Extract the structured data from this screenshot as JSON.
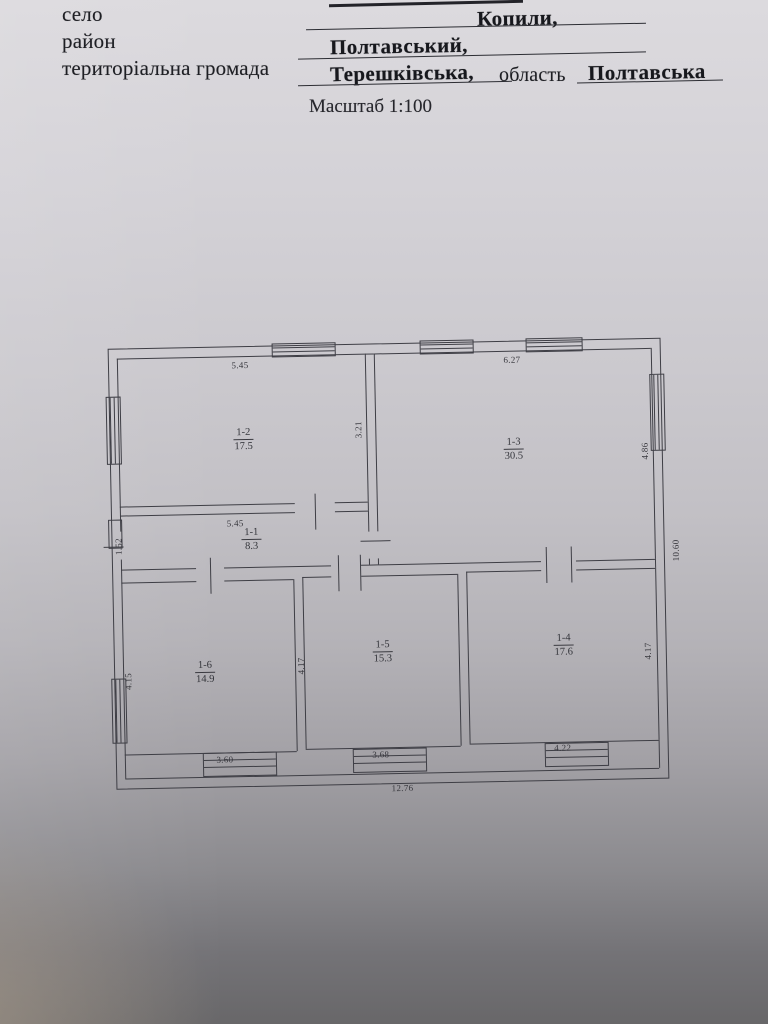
{
  "document": {
    "header": {
      "rows": [
        {
          "label": "село",
          "value": "Копили,"
        },
        {
          "label": "район",
          "value": "Полтавський,"
        },
        {
          "label": "територіальна громада",
          "value": "Терешківська,",
          "label2": "область",
          "value2": "Полтавська"
        }
      ],
      "scale": "Масштаб 1:100"
    },
    "plan": {
      "rooms": [
        {
          "id": "1-2",
          "area": "17.5"
        },
        {
          "id": "1-1",
          "area": "8.3"
        },
        {
          "id": "1-3",
          "area": "30.5"
        },
        {
          "id": "1-6",
          "area": "14.9"
        },
        {
          "id": "1-5",
          "area": "15.3"
        },
        {
          "id": "1-4",
          "area": "17.6"
        }
      ],
      "dims": {
        "r12_top": "5.45",
        "r13_top": "6.27",
        "r12_right": "3.21",
        "r13_right": "4.86",
        "r11_top": "5.45",
        "r11_left": "1.52",
        "r16_left": "4.15",
        "r16_r15_wall": "4.17",
        "r14_right": "4.17",
        "r16_bottom": "3.60",
        "r15_bottom": "3.68",
        "r14_bottom": "4.22",
        "total_width": "12.76",
        "total_height": "10.60"
      }
    }
  }
}
